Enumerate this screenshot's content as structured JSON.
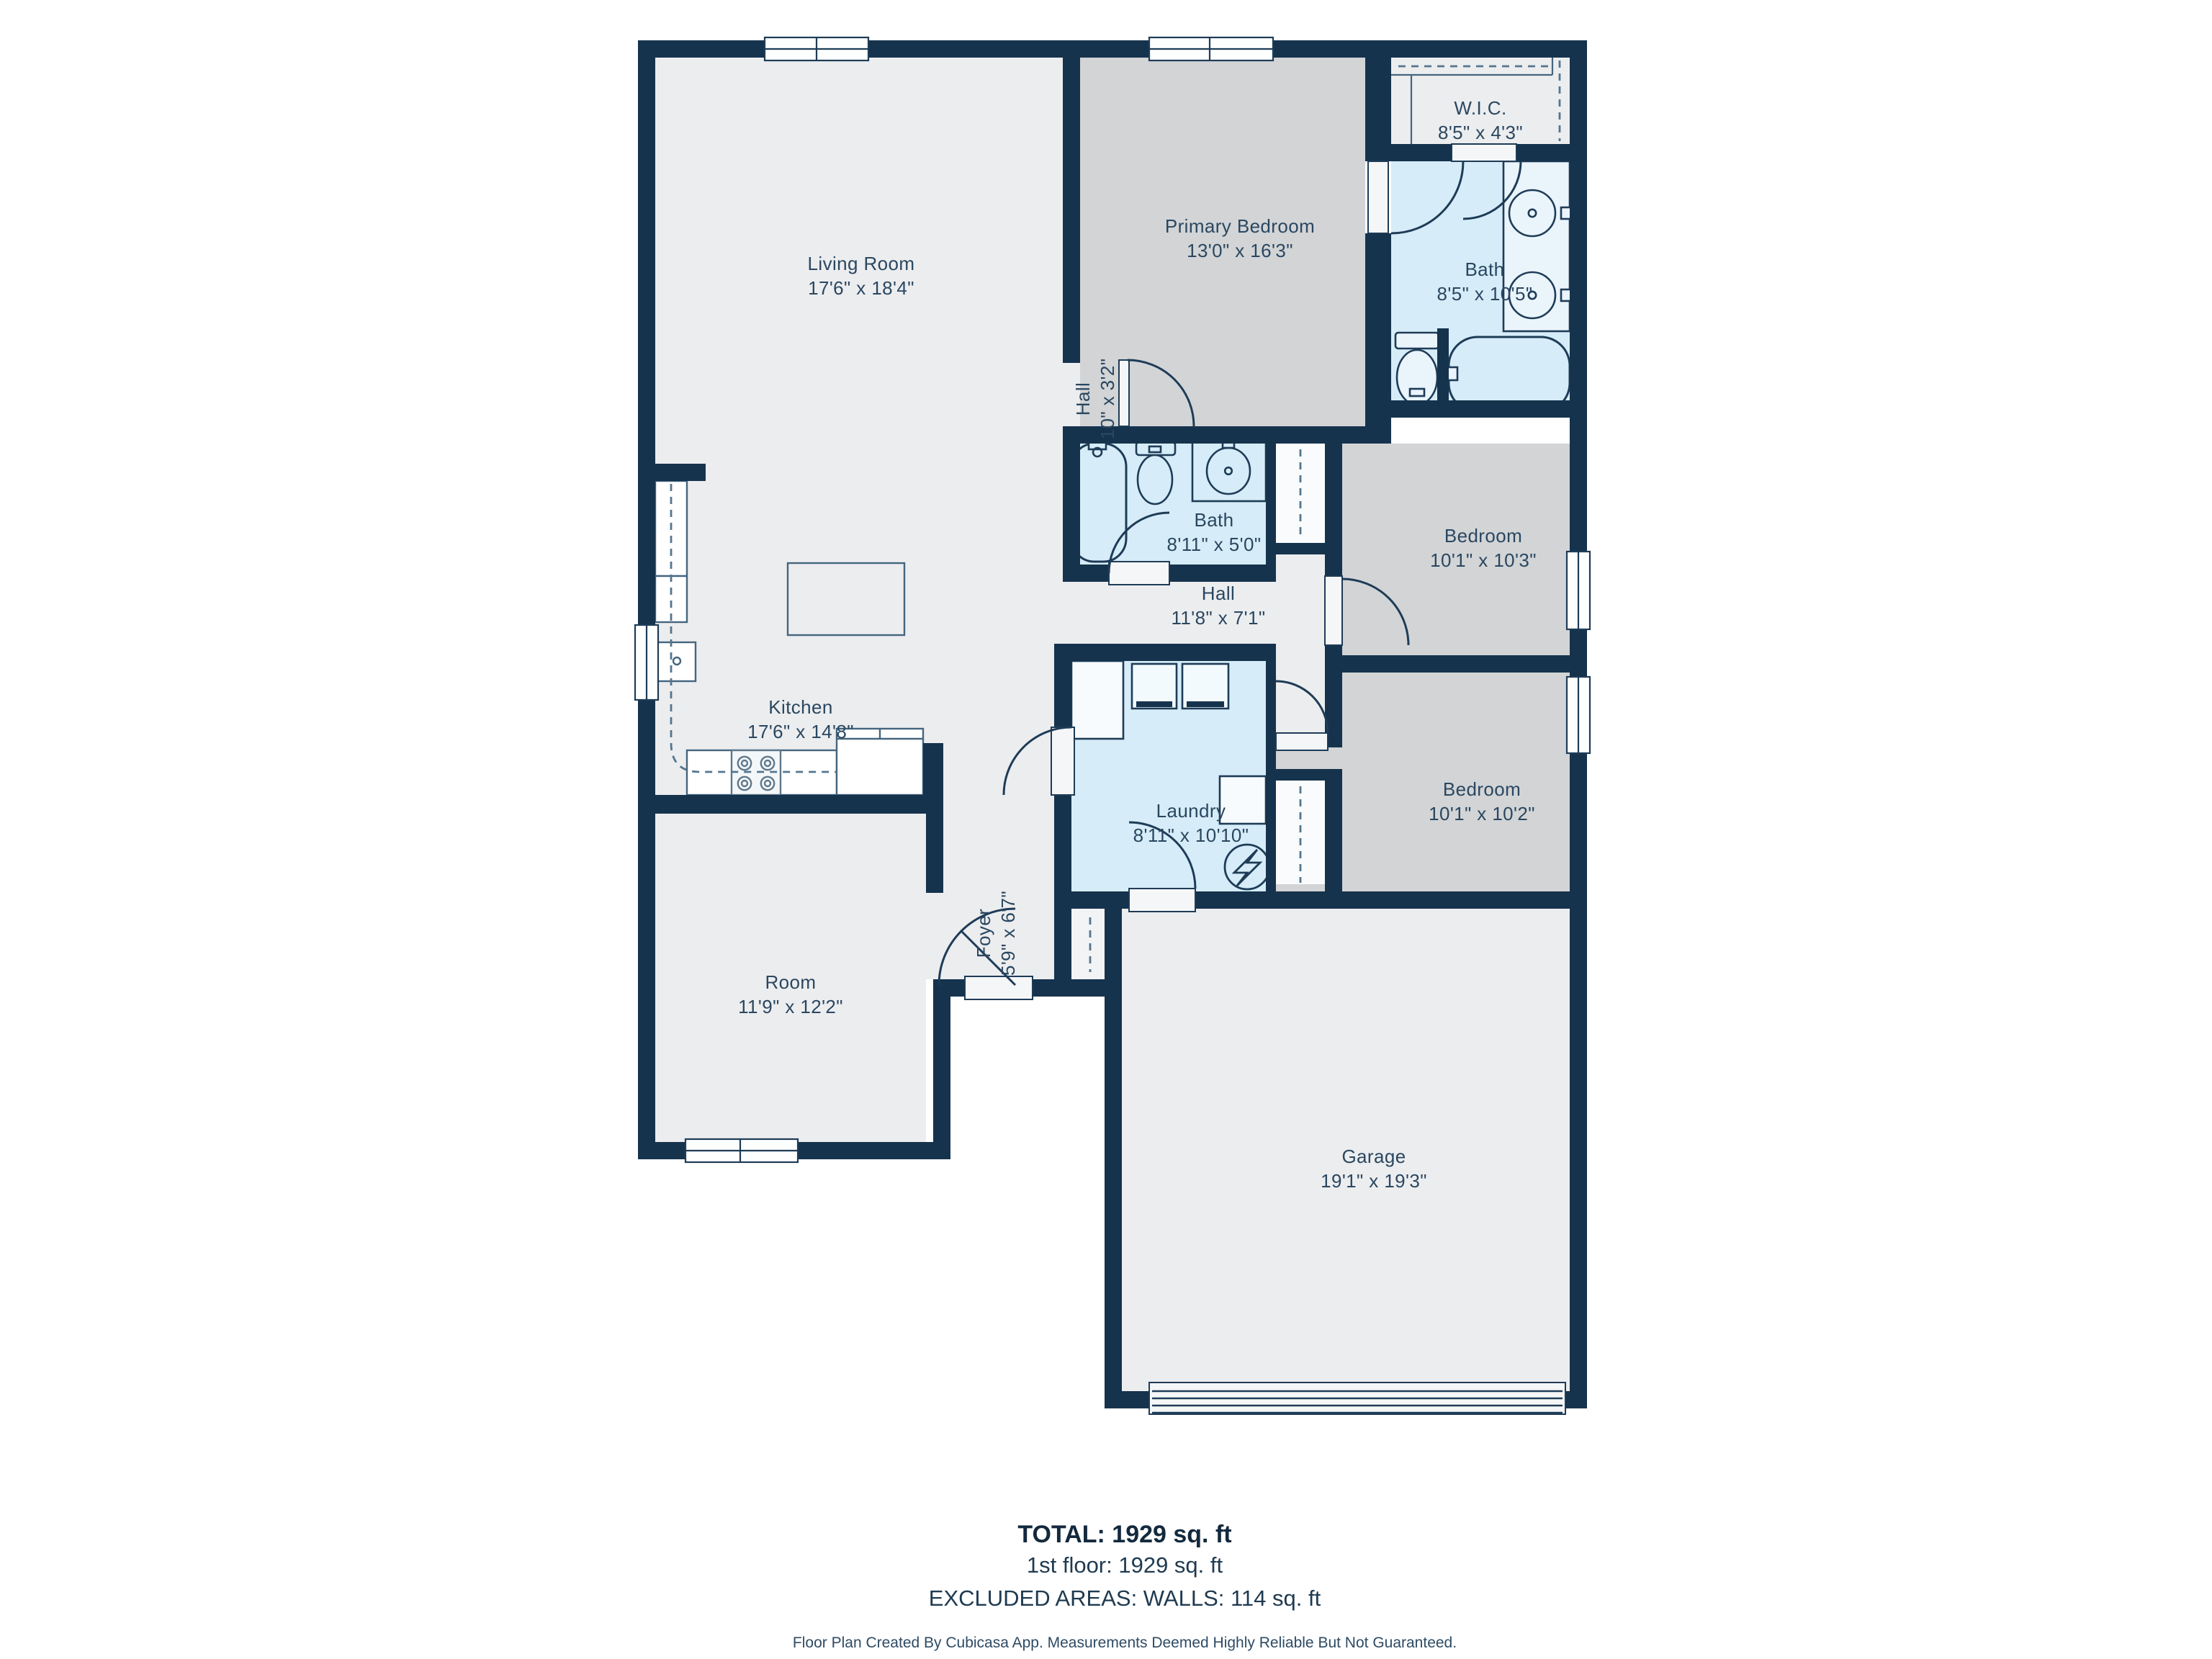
{
  "plan": {
    "rooms": {
      "living": {
        "name": "Living Room",
        "dims": "17'6\" x 18'4\""
      },
      "kitchen": {
        "name": "Kitchen",
        "dims": "17'6\" x 14'8\""
      },
      "room": {
        "name": "Room",
        "dims": "11'9\" x 12'2\""
      },
      "foyer": {
        "name": "Foyer",
        "dims": "5'9\" x 6'7\""
      },
      "primary_bedroom": {
        "name": "Primary Bedroom",
        "dims": "13'0\" x 16'3\""
      },
      "wic": {
        "name": "W.I.C.",
        "dims": "8'5\" x 4'3\""
      },
      "primary_bath": {
        "name": "Bath",
        "dims": "8'5\" x 10'5\""
      },
      "hall_small": {
        "name": "Hall",
        "dims": "10\" x 3'2\""
      },
      "hall_bath": {
        "name": "Bath",
        "dims": "8'11\" x 5'0\""
      },
      "hall": {
        "name": "Hall",
        "dims": "11'8\" x 7'1\""
      },
      "bedroom1": {
        "name": "Bedroom",
        "dims": "10'1\" x 10'3\""
      },
      "bedroom2": {
        "name": "Bedroom",
        "dims": "10'1\" x 10'2\""
      },
      "laundry": {
        "name": "Laundry",
        "dims": "8'11\" x 10'10\""
      },
      "garage": {
        "name": "Garage",
        "dims": "19'1\" x 19'3\""
      }
    },
    "summary": {
      "total": "TOTAL: 1929 sq. ft",
      "floor1": "1st floor: 1929 sq. ft",
      "excluded": "EXCLUDED AREAS: WALLS: 114 sq. ft"
    },
    "disclaimer": "Floor Plan Created By Cubicasa App. Measurements Deemed Highly Reliable But Not Guaranteed.",
    "colors": {
      "wall": "#16334D",
      "room_light": "#ECEDEF",
      "bedroom_gray": "#D2D4D6",
      "wet_blue": "#D6ECF8",
      "label_text": "#2A4760"
    }
  }
}
